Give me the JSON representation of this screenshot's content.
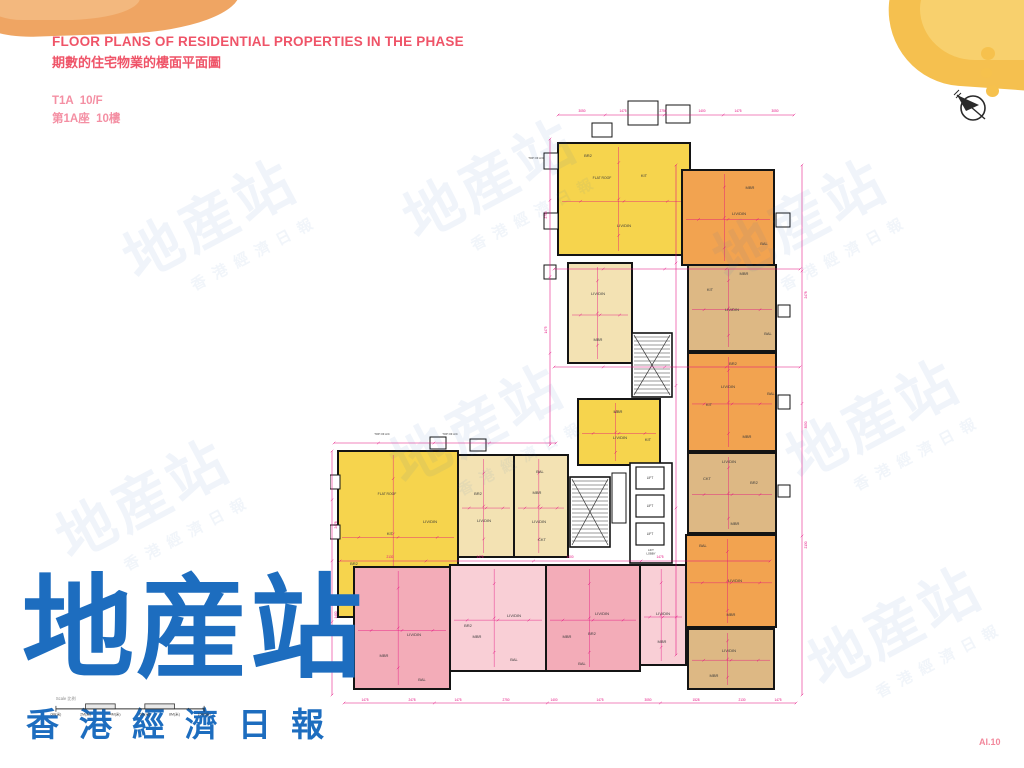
{
  "header": {
    "title_en": "FLOOR PLANS OF RESIDENTIAL PROPERTIES IN THE PHASE",
    "title_zh": "期數的住宅物業的樓面平面圖",
    "floor_en": "T1A  10/F",
    "floor_zh": "第1A座  10樓"
  },
  "page_number": "AI.10",
  "logo": {
    "main": "地産站",
    "sub": "香港經濟日報"
  },
  "watermark": {
    "main": "地産站",
    "sub": "香港經濟日報",
    "positions": [
      [
        215,
        225
      ],
      [
        495,
        185
      ],
      [
        805,
        225
      ],
      [
        148,
        505
      ],
      [
        482,
        430
      ],
      [
        878,
        425
      ],
      [
        900,
        632
      ]
    ]
  },
  "scale_bar": {
    "label": "Scale 比例",
    "ticks": [
      "0M(米)",
      "2M(米)",
      "4M(米)",
      "6M(米)",
      "8M(米)",
      "10M(米)"
    ]
  },
  "colors": {
    "dim": "#e40a7e",
    "wall": "#141414",
    "room_text": "#3a3a3a",
    "units": {
      "yellow": "#f6d44d",
      "orange": "#f2a350",
      "tan": "#ddb884",
      "cream": "#f3e2b3",
      "pink": "#f3acb8",
      "pinklight": "#f9cfd6"
    }
  },
  "plan": {
    "width": 490,
    "height": 615,
    "units": [
      {
        "x": 228,
        "y": 48,
        "w": 132,
        "h": 112,
        "c": "yellow",
        "rooms": [
          [
            "FLAT ROOF",
            272,
            84
          ],
          [
            "KIT",
            314,
            82
          ],
          [
            "LIV/DIN",
            294,
            132
          ],
          [
            "BR2",
            258,
            62
          ]
        ]
      },
      {
        "x": 352,
        "y": 75,
        "w": 92,
        "h": 95,
        "c": "orange",
        "rooms": [
          [
            "MBR",
            420,
            94
          ],
          [
            "LIV/DIN",
            409,
            120
          ],
          [
            "BAL",
            434,
            150
          ]
        ]
      },
      {
        "x": 238,
        "y": 168,
        "w": 64,
        "h": 100,
        "c": "cream",
        "rooms": [
          [
            "LIV/DIN",
            268,
            200
          ],
          [
            "MBR",
            268,
            246
          ]
        ]
      },
      {
        "x": 358,
        "y": 170,
        "w": 88,
        "h": 86,
        "c": "tan",
        "rooms": [
          [
            "MBR",
            414,
            180
          ],
          [
            "KIT",
            380,
            196
          ],
          [
            "LIV/DIN",
            402,
            216
          ],
          [
            "BAL",
            438,
            240
          ]
        ]
      },
      {
        "x": 248,
        "y": 304,
        "w": 82,
        "h": 66,
        "c": "yellow",
        "rooms": [
          [
            "MBR",
            288,
            318
          ],
          [
            "LIV/DIN",
            290,
            344
          ],
          [
            "KIT",
            318,
            346
          ]
        ]
      },
      {
        "x": 358,
        "y": 258,
        "w": 88,
        "h": 98,
        "c": "orange",
        "rooms": [
          [
            "BR2",
            403,
            270
          ],
          [
            "LIV/DIN",
            398,
            293
          ],
          [
            "KIT",
            379,
            311
          ],
          [
            "MBR",
            417,
            343
          ],
          [
            "BAL",
            441,
            300
          ]
        ]
      },
      {
        "x": 358,
        "y": 358,
        "w": 88,
        "h": 80,
        "c": "tan",
        "rooms": [
          [
            "LIV/DIN",
            399,
            368
          ],
          [
            "CKT",
            377,
            385
          ],
          [
            "BR2",
            424,
            389
          ],
          [
            "MBR",
            405,
            430
          ]
        ]
      },
      {
        "x": 356,
        "y": 440,
        "w": 90,
        "h": 92,
        "c": "orange",
        "rooms": [
          [
            "BAL",
            373,
            452
          ],
          [
            "LIV/DIN",
            405,
            487
          ],
          [
            "MBR",
            401,
            521
          ]
        ]
      },
      {
        "x": 358,
        "y": 534,
        "w": 86,
        "h": 60,
        "c": "tan",
        "rooms": [
          [
            "LIV/DIN",
            399,
            557
          ],
          [
            "MBR",
            384,
            582
          ]
        ]
      },
      {
        "x": 8,
        "y": 356,
        "w": 120,
        "h": 166,
        "c": "yellow",
        "rooms": [
          [
            "FLAT ROOF",
            57,
            400
          ],
          [
            "LIV/DIN",
            100,
            428
          ],
          [
            "KIT",
            60,
            440
          ],
          [
            "BR2",
            24,
            470
          ],
          [
            "MBA",
            72,
            498
          ],
          [
            "MBR",
            30,
            510
          ]
        ]
      },
      {
        "x": 128,
        "y": 360,
        "w": 56,
        "h": 102,
        "c": "cream",
        "rooms": [
          [
            "BR2",
            148,
            400
          ],
          [
            "LIV/DIN",
            154,
            427
          ]
        ]
      },
      {
        "x": 184,
        "y": 360,
        "w": 54,
        "h": 102,
        "c": "cream",
        "rooms": [
          [
            "BAL",
            210,
            378
          ],
          [
            "MBR",
            207,
            399
          ],
          [
            "LIV/DIN",
            209,
            428
          ],
          [
            "CKT",
            212,
            446
          ]
        ]
      },
      {
        "x": 24,
        "y": 472,
        "w": 96,
        "h": 122,
        "c": "pink",
        "rooms": [
          [
            "LIV/DIN",
            84,
            541
          ],
          [
            "MBR",
            54,
            562
          ],
          [
            "BAL",
            92,
            586
          ]
        ]
      },
      {
        "x": 120,
        "y": 470,
        "w": 96,
        "h": 106,
        "c": "pinklight",
        "rooms": [
          [
            "BR2",
            138,
            532
          ],
          [
            "LIV/DIN",
            184,
            522
          ],
          [
            "MBR",
            147,
            543
          ],
          [
            "BAL",
            184,
            566
          ]
        ]
      },
      {
        "x": 216,
        "y": 470,
        "w": 94,
        "h": 106,
        "c": "pink",
        "rooms": [
          [
            "LIV/DIN",
            272,
            520
          ],
          [
            "BR2",
            262,
            540
          ],
          [
            "MBR",
            237,
            543
          ],
          [
            "BAL",
            252,
            570
          ]
        ]
      },
      {
        "x": 310,
        "y": 470,
        "w": 46,
        "h": 100,
        "c": "pinklight",
        "rooms": [
          [
            "LIV/DIN",
            333,
            520
          ],
          [
            "MBR",
            332,
            548
          ]
        ]
      }
    ],
    "cores": [
      {
        "type": "stair",
        "x": 302,
        "y": 238,
        "w": 40,
        "h": 64
      },
      {
        "type": "stair",
        "x": 240,
        "y": 382,
        "w": 40,
        "h": 70
      },
      {
        "type": "lobby",
        "x": 300,
        "y": 368,
        "w": 42,
        "h": 100
      }
    ],
    "lifts": {
      "label": "LIFT",
      "lobby_label": "LIFT LOBBY",
      "lobby_pos": [
        321,
        456
      ],
      "boxes": [
        [
          306,
          372,
          28,
          22
        ],
        [
          306,
          400,
          28,
          22
        ],
        [
          306,
          428,
          28,
          22
        ]
      ]
    },
    "small_boxes": [
      [
        214,
        58,
        14,
        16
      ],
      [
        214,
        118,
        14,
        16
      ],
      [
        214,
        170,
        12,
        14
      ],
      [
        446,
        118,
        14,
        14
      ],
      [
        448,
        210,
        12,
        12
      ],
      [
        448,
        300,
        12,
        14
      ],
      [
        448,
        390,
        12,
        12
      ],
      [
        298,
        6,
        30,
        24
      ],
      [
        336,
        10,
        24,
        18
      ],
      [
        262,
        28,
        20,
        14
      ],
      [
        100,
        342,
        16,
        12
      ],
      [
        140,
        344,
        16,
        12
      ],
      [
        0,
        380,
        10,
        14
      ],
      [
        0,
        430,
        10,
        14
      ],
      [
        282,
        378,
        14,
        50
      ]
    ],
    "dims": [
      [
        228,
        20,
        464,
        20
      ],
      [
        472,
        70,
        472,
        600
      ],
      [
        220,
        44,
        220,
        350
      ],
      [
        4,
        348,
        226,
        348
      ],
      [
        2,
        356,
        2,
        600
      ],
      [
        14,
        608,
        466,
        608
      ],
      [
        10,
        466,
        440,
        466
      ],
      [
        224,
        272,
        470,
        272
      ],
      [
        346,
        70,
        346,
        560
      ],
      [
        224,
        174,
        470,
        174
      ]
    ],
    "dim_labels": [
      {
        "t": "3050",
        "x": 252,
        "y": 17
      },
      {
        "t": "1475",
        "x": 293,
        "y": 17
      },
      {
        "t": "2750",
        "x": 333,
        "y": 17
      },
      {
        "t": "1400",
        "x": 372,
        "y": 17
      },
      {
        "t": "1475",
        "x": 408,
        "y": 17
      },
      {
        "t": "3050",
        "x": 445,
        "y": 17
      },
      {
        "t": "1475",
        "x": 35,
        "y": 606
      },
      {
        "t": "2478",
        "x": 82,
        "y": 606
      },
      {
        "t": "1475",
        "x": 128,
        "y": 606
      },
      {
        "t": "2750",
        "x": 176,
        "y": 606
      },
      {
        "t": "1400",
        "x": 224,
        "y": 606
      },
      {
        "t": "1475",
        "x": 270,
        "y": 606
      },
      {
        "t": "3050",
        "x": 318,
        "y": 606
      },
      {
        "t": "1528",
        "x": 366,
        "y": 606
      },
      {
        "t": "2130",
        "x": 412,
        "y": 606
      },
      {
        "t": "1475",
        "x": 448,
        "y": 606
      },
      {
        "t": "2478",
        "x": 477,
        "y": 200,
        "r": 1
      },
      {
        "t": "3050",
        "x": 477,
        "y": 330,
        "r": 1
      },
      {
        "t": "2130",
        "x": 477,
        "y": 450,
        "r": 1
      },
      {
        "t": "2750",
        "x": 217,
        "y": 120,
        "r": 1
      },
      {
        "t": "1475",
        "x": 217,
        "y": 235,
        "r": 1
      },
      {
        "t": "2478",
        "x": 7,
        "y": 430,
        "r": 1
      },
      {
        "t": "1400",
        "x": 7,
        "y": 520,
        "r": 1
      },
      {
        "t": "2130",
        "x": 60,
        "y": 463
      },
      {
        "t": "1475",
        "x": 150,
        "y": 463
      },
      {
        "t": "1400",
        "x": 240,
        "y": 463
      },
      {
        "t": "1475",
        "x": 330,
        "y": 463
      }
    ],
    "notes": [
      {
        "t": "TOP OF A/C",
        "x": 206,
        "y": 64
      },
      {
        "t": "TOP OF A/C",
        "x": 52,
        "y": 340
      },
      {
        "t": "TOP OF A/C",
        "x": 120,
        "y": 340
      }
    ]
  }
}
